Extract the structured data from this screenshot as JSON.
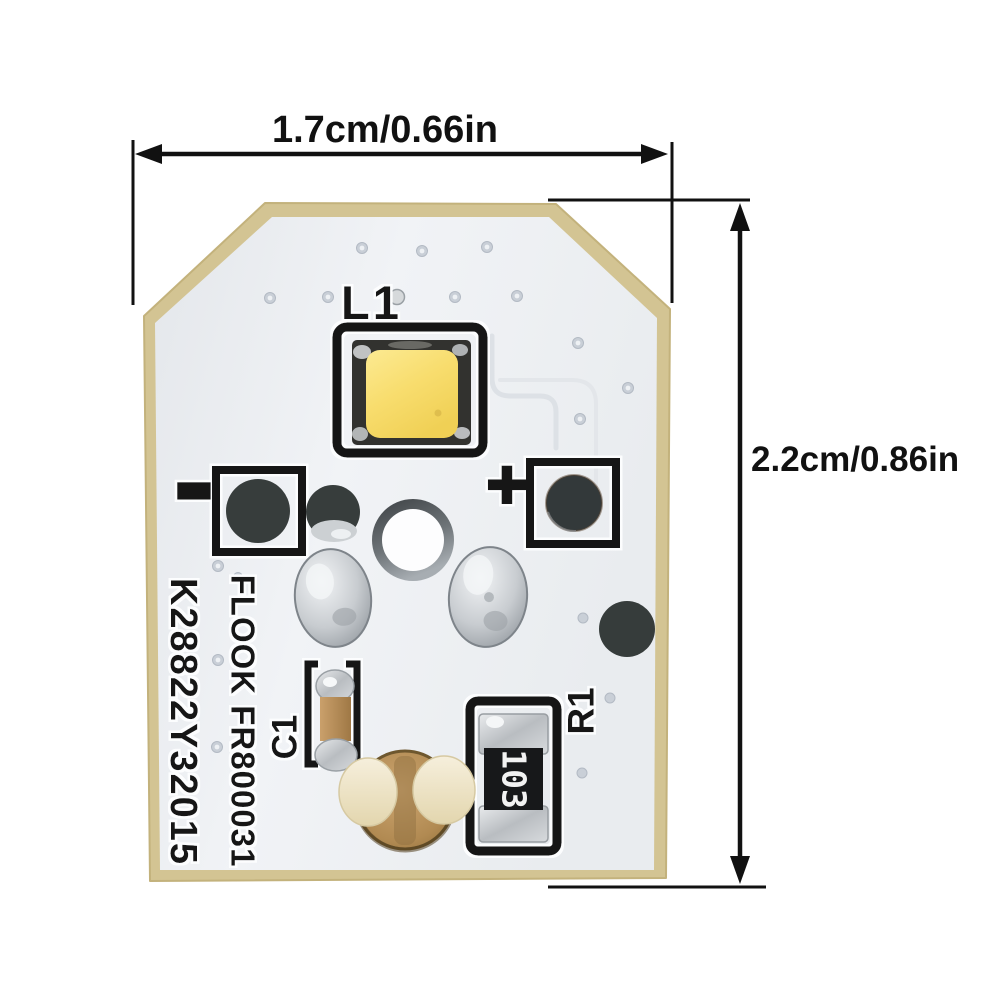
{
  "annotations": {
    "width_label": "1.7cm/0.66in",
    "height_label": "2.2cm/0.86in"
  },
  "board": {
    "led_designator": "L1",
    "capacitor_designator": "C1",
    "resistor_designator": "R1",
    "resistor_value": "103",
    "polarity_positive": "+",
    "polarity_negative": "-",
    "marking_line_1": "K28822Y32015",
    "marking_line_2": "FLOOK FR800031"
  },
  "colors": {
    "background": "#ffffff",
    "board_edge": "#d3c493",
    "board_face": "#edeff2",
    "silkscreen": "#161616",
    "led_phosphor": "#f7db6d",
    "solder": "#d3d6d9",
    "dark_pad": "#373d3c",
    "connector_body": "#bb9260",
    "connector_tabs": "#f0e6cd",
    "annotation_ink": "#111111"
  }
}
